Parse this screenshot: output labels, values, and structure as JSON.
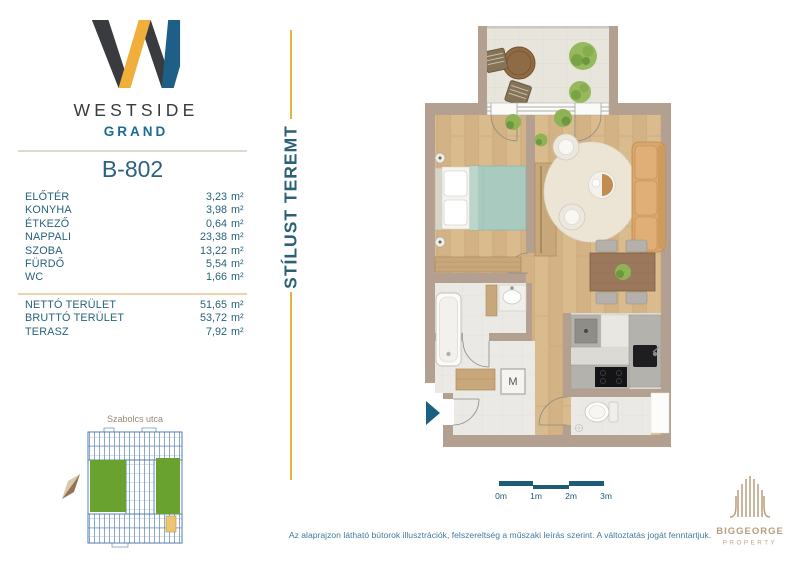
{
  "brand": {
    "wordmark": "WESTSIDE",
    "submark": "GRAND"
  },
  "unit": {
    "code": "B-802"
  },
  "areas": {
    "rooms": [
      {
        "label": "ELŐTÉR",
        "value": "3,23",
        "unit": "m²"
      },
      {
        "label": "KONYHA",
        "value": "3,98",
        "unit": "m²"
      },
      {
        "label": "ÉTKEZŐ",
        "value": "0,64",
        "unit": "m²"
      },
      {
        "label": "NAPPALI",
        "value": "23,38",
        "unit": "m²"
      },
      {
        "label": "SZOBA",
        "value": "13,22",
        "unit": "m²"
      },
      {
        "label": "FÜRDŐ",
        "value": "5,54",
        "unit": "m²"
      },
      {
        "label": "WC",
        "value": "1,66",
        "unit": "m²"
      }
    ],
    "totals": [
      {
        "label": "NETTÓ TERÜLET",
        "value": "51,65",
        "unit": "m²"
      },
      {
        "label": "BRUTTÓ TERÜLET",
        "value": "53,72",
        "unit": "m²"
      },
      {
        "label": "TERASZ",
        "value": "7,92",
        "unit": "m²"
      }
    ]
  },
  "tagline": "STÍLUST TEREMT",
  "floorplan": {
    "washing_machine_label": "M"
  },
  "scalebar": {
    "labels": [
      "0m",
      "1m",
      "2m",
      "3m"
    ]
  },
  "sitemap": {
    "street_label": "Szabolcs utca"
  },
  "partner": {
    "name": "BIGGEORGE",
    "division": "PROPERTY"
  },
  "footer": {
    "disclaimer": "Az alaprajzon látható bútorok illusztrációk, felszereltség a műszaki leírás szerint. A változtatás jogát fenntartjuk."
  },
  "colors": {
    "accent_gold": "#e5b43d",
    "brand_teal": "#26617c",
    "brand_blue": "#1d6b95",
    "brand_dark": "#3a3b3f",
    "entrance_arrow_blue": "#1a6080",
    "partner_tan": "#b79e7c"
  }
}
